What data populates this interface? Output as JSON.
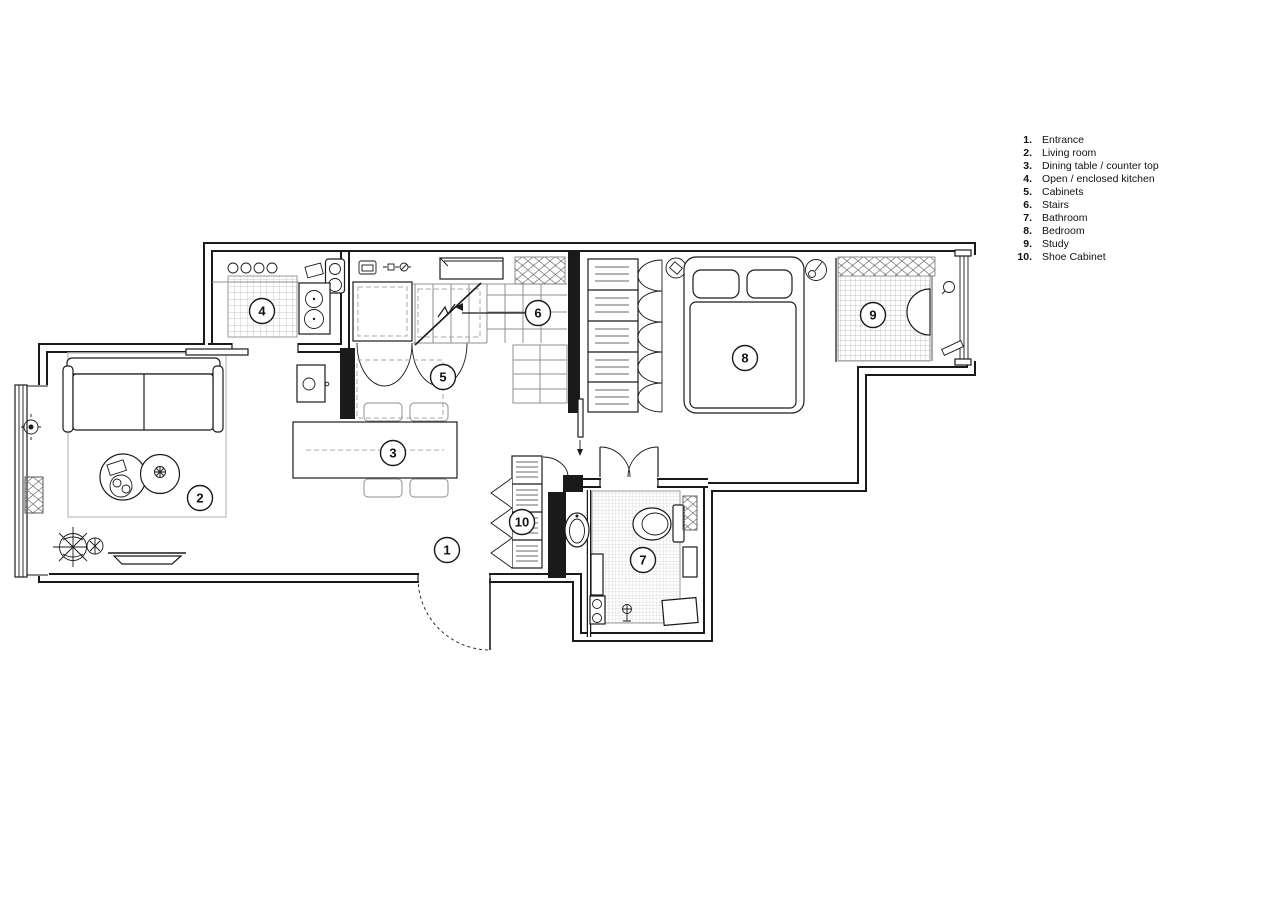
{
  "legend": {
    "items": [
      {
        "num": "1.",
        "label": "Entrance"
      },
      {
        "num": "2.",
        "label": "Living room"
      },
      {
        "num": "3.",
        "label": "Dining table / counter top"
      },
      {
        "num": "4.",
        "label": "Open / enclosed kitchen"
      },
      {
        "num": "5.",
        "label": "Cabinets"
      },
      {
        "num": "6.",
        "label": "Stairs"
      },
      {
        "num": "7.",
        "label": "Bathroom"
      },
      {
        "num": "8.",
        "label": "Bedroom"
      },
      {
        "num": "9.",
        "label": "Study"
      },
      {
        "num": "10.",
        "label": "Shoe Cabinet"
      }
    ]
  },
  "plan": {
    "colors": {
      "line": "#1a1a1a",
      "tile": "#b5b5b5",
      "hatch": "#777777"
    },
    "markers": [
      {
        "num": "1",
        "x": 447,
        "y": 550
      },
      {
        "num": "2",
        "x": 200,
        "y": 498
      },
      {
        "num": "3",
        "x": 393,
        "y": 453
      },
      {
        "num": "4",
        "x": 262,
        "y": 311
      },
      {
        "num": "5",
        "x": 443,
        "y": 377
      },
      {
        "num": "6",
        "x": 538,
        "y": 313,
        "leader": {
          "x2": 462,
          "y2": 313
        }
      },
      {
        "num": "7",
        "x": 643,
        "y": 560
      },
      {
        "num": "8",
        "x": 745,
        "y": 358
      },
      {
        "num": "9",
        "x": 873,
        "y": 315
      },
      {
        "num": "10",
        "x": 522,
        "y": 522
      }
    ]
  }
}
